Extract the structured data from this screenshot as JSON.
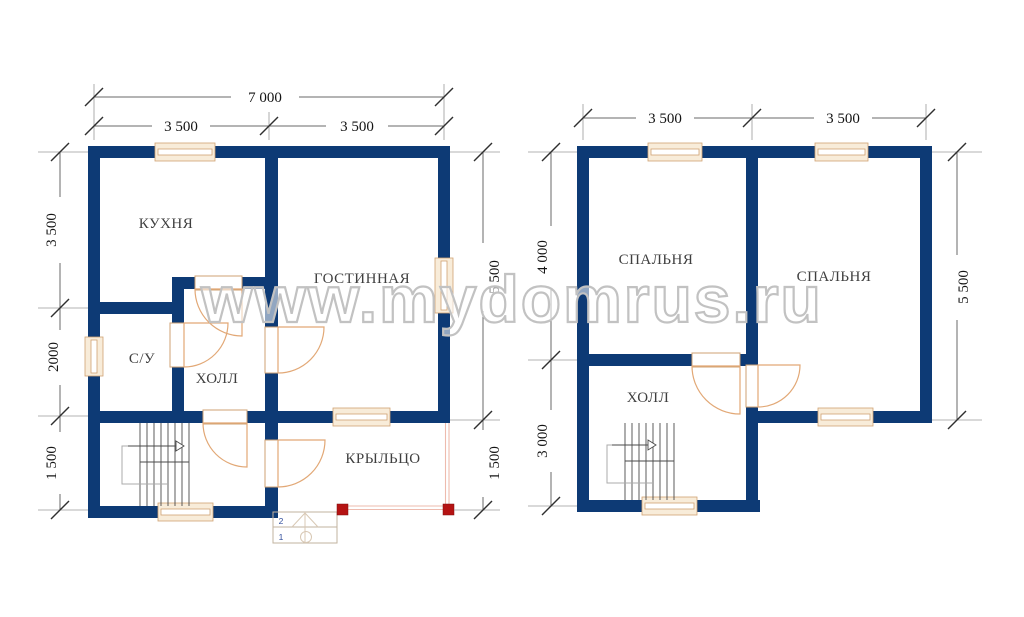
{
  "watermark": "www.mydomrus.ru",
  "colors": {
    "wall": "#0d3a75",
    "window_fill": "#f8ecd9",
    "window_border": "#cfa273",
    "door": "#e2a876",
    "post_red": "#b51313",
    "porch_line": "#eebbae",
    "dimension_line": "#6a6a6a",
    "label_text": "#3f3f3f",
    "watermark_outline": "#c2c2c2"
  },
  "floor1": {
    "rooms": {
      "kitchen": "КУХНЯ",
      "living": "ГОСТИННАЯ",
      "bath": "С/У",
      "hall": "ХОЛЛ",
      "porch": "КРЫЛЬЦО"
    },
    "dims": {
      "total_width": "7 000",
      "width_left": "3 500",
      "width_right": "3 500",
      "left_top": "3 500",
      "left_mid": "2000",
      "left_bottom": "1 500",
      "right_top": "5 500",
      "right_bottom": "1 500"
    },
    "steps": {
      "step2": "2",
      "step1": "1"
    }
  },
  "floor2": {
    "rooms": {
      "bedroom_left": "СПАЛЬНЯ",
      "bedroom_right": "СПАЛЬНЯ",
      "hall": "ХОЛЛ"
    },
    "dims": {
      "width_left": "3 500",
      "width_right": "3 500",
      "left_top": "4 000",
      "left_bottom": "3 000",
      "right": "5 500"
    }
  }
}
